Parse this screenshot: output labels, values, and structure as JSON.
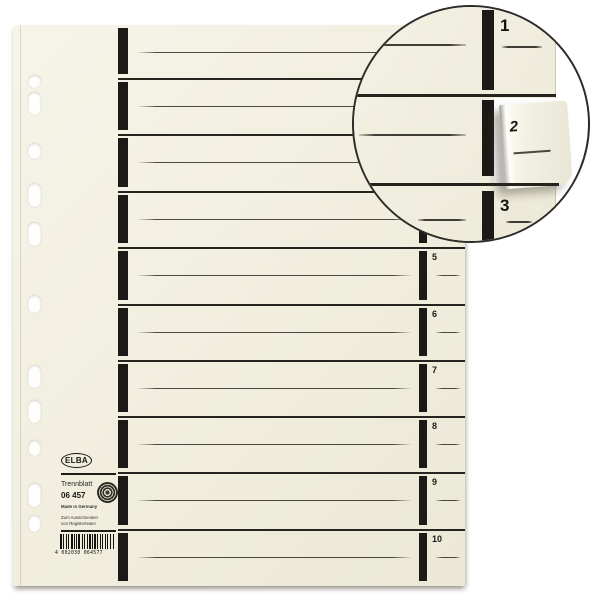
{
  "product": {
    "brand": "ELBA",
    "name": "Trennblatt",
    "article_number": "06 457",
    "origin": "Made in Germany",
    "note_line1": "Zum Ausschneiden",
    "note_line2": "von Registerteilen",
    "barcode_text": "4 002030 064577"
  },
  "sheet": {
    "section_labels": [
      "1",
      "2",
      "3",
      "4",
      "5",
      "6",
      "7",
      "8",
      "9",
      "10"
    ],
    "visible_section_labels": [
      "5",
      "6",
      "7",
      "8",
      "9",
      "10"
    ]
  },
  "magnifier": {
    "tab_label_top": "1",
    "peeled_tab_label": "2",
    "tab_label_bottom": "3"
  },
  "colors": {
    "background": "#ffffff",
    "paper": "#f1eede",
    "bar": "#1b1a17",
    "rule": "#26241f",
    "text": "#1d1b17"
  }
}
